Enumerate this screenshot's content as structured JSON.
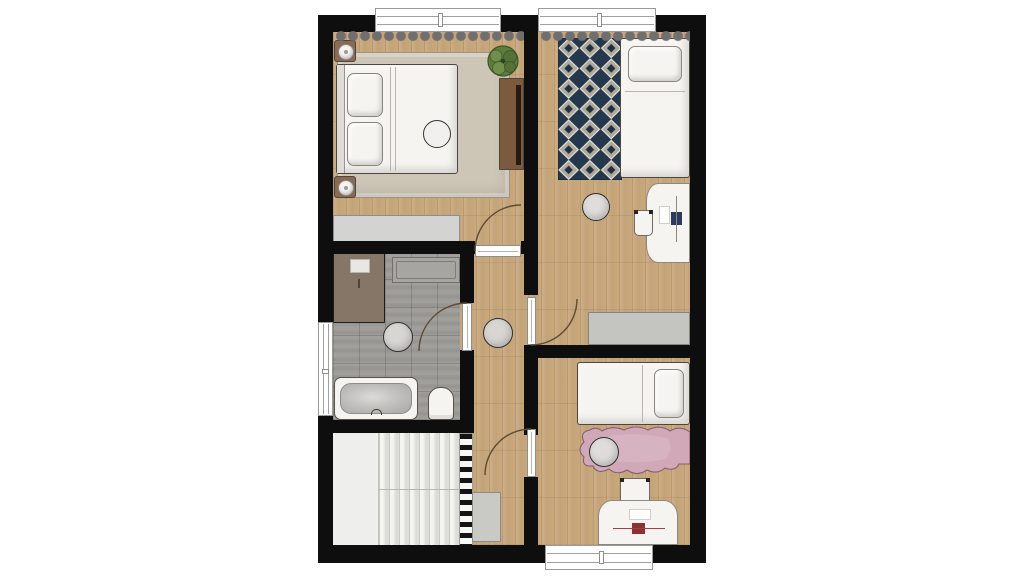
{
  "meta": {
    "type": "architectural-floor-plan",
    "view": "top-down upper floor",
    "canvas": {
      "width": 1024,
      "height": 576
    },
    "window_count": 4,
    "door_count": 4
  },
  "colors": {
    "page_bg": "#ffffff",
    "wall": "#0e0e0e",
    "wood": "#c9a87c",
    "tile": "#9b9a96",
    "stairs": "#eeeeec",
    "railing_white": "#f7f7f5",
    "rug_master": "#cdc5b6",
    "rug_hall": "#d7d6d3",
    "rug_bath": "#d7d6d3",
    "rug_pink": "#d0a8b8",
    "rug_navy_bg": "#24384d",
    "rug_diamond": "#b0a898",
    "rug_diamond_center": "#1d3145",
    "white_furniture": "#f5f4f1",
    "gray_furniture": "#c4c4c1",
    "gray_dresser": "#d3d3d1",
    "cabinet_gray": "#c9c9c6",
    "brown_unit": "#7b5a3d",
    "tv_dark": "#241c14",
    "shower": "#867668",
    "counter": "#a7a5a1",
    "plant": "#5f7d3e",
    "plant_dark": "#3f5626",
    "pouf": "#dedddb",
    "window": "#ffffff",
    "door_leaf": "#fcfcfa",
    "door_arc": "#5d4c33",
    "laptop_navy": "#2b3a5e",
    "laptop_red": "#8e2f33",
    "nightstand_brown": "#8a6a50",
    "curtain": "#6f6f6f"
  },
  "rooms": [
    {
      "id": "bedroom-master",
      "position": "top-left",
      "furniture": [
        "double-bed",
        "pillows",
        "nightstand-with-lamp",
        "nightstand-with-lamp",
        "area-rug",
        "potted-plant",
        "sideboard-with-tv",
        "dresser",
        "curtain",
        "round-decor"
      ]
    },
    {
      "id": "bedroom-top-right",
      "position": "top-right",
      "furniture": [
        "single-bed",
        "diamond-pattern-rug",
        "desk",
        "desk-chair",
        "laptop",
        "round-pouf",
        "wardrobe",
        "curtain"
      ]
    },
    {
      "id": "bathroom",
      "position": "middle-left",
      "furniture": [
        "shower",
        "counter",
        "bathtub",
        "toilet",
        "round-rug"
      ]
    },
    {
      "id": "stairwell",
      "position": "bottom-left",
      "furniture": [
        "u-shaped-stairs",
        "railing"
      ]
    },
    {
      "id": "hallway",
      "position": "center",
      "furniture": [
        "round-rug",
        "cabinet"
      ]
    },
    {
      "id": "bedroom-bottom-right",
      "position": "bottom-right",
      "furniture": [
        "single-bed",
        "pink-rug",
        "round-pouf",
        "desk",
        "desk-chair",
        "laptop"
      ]
    }
  ]
}
